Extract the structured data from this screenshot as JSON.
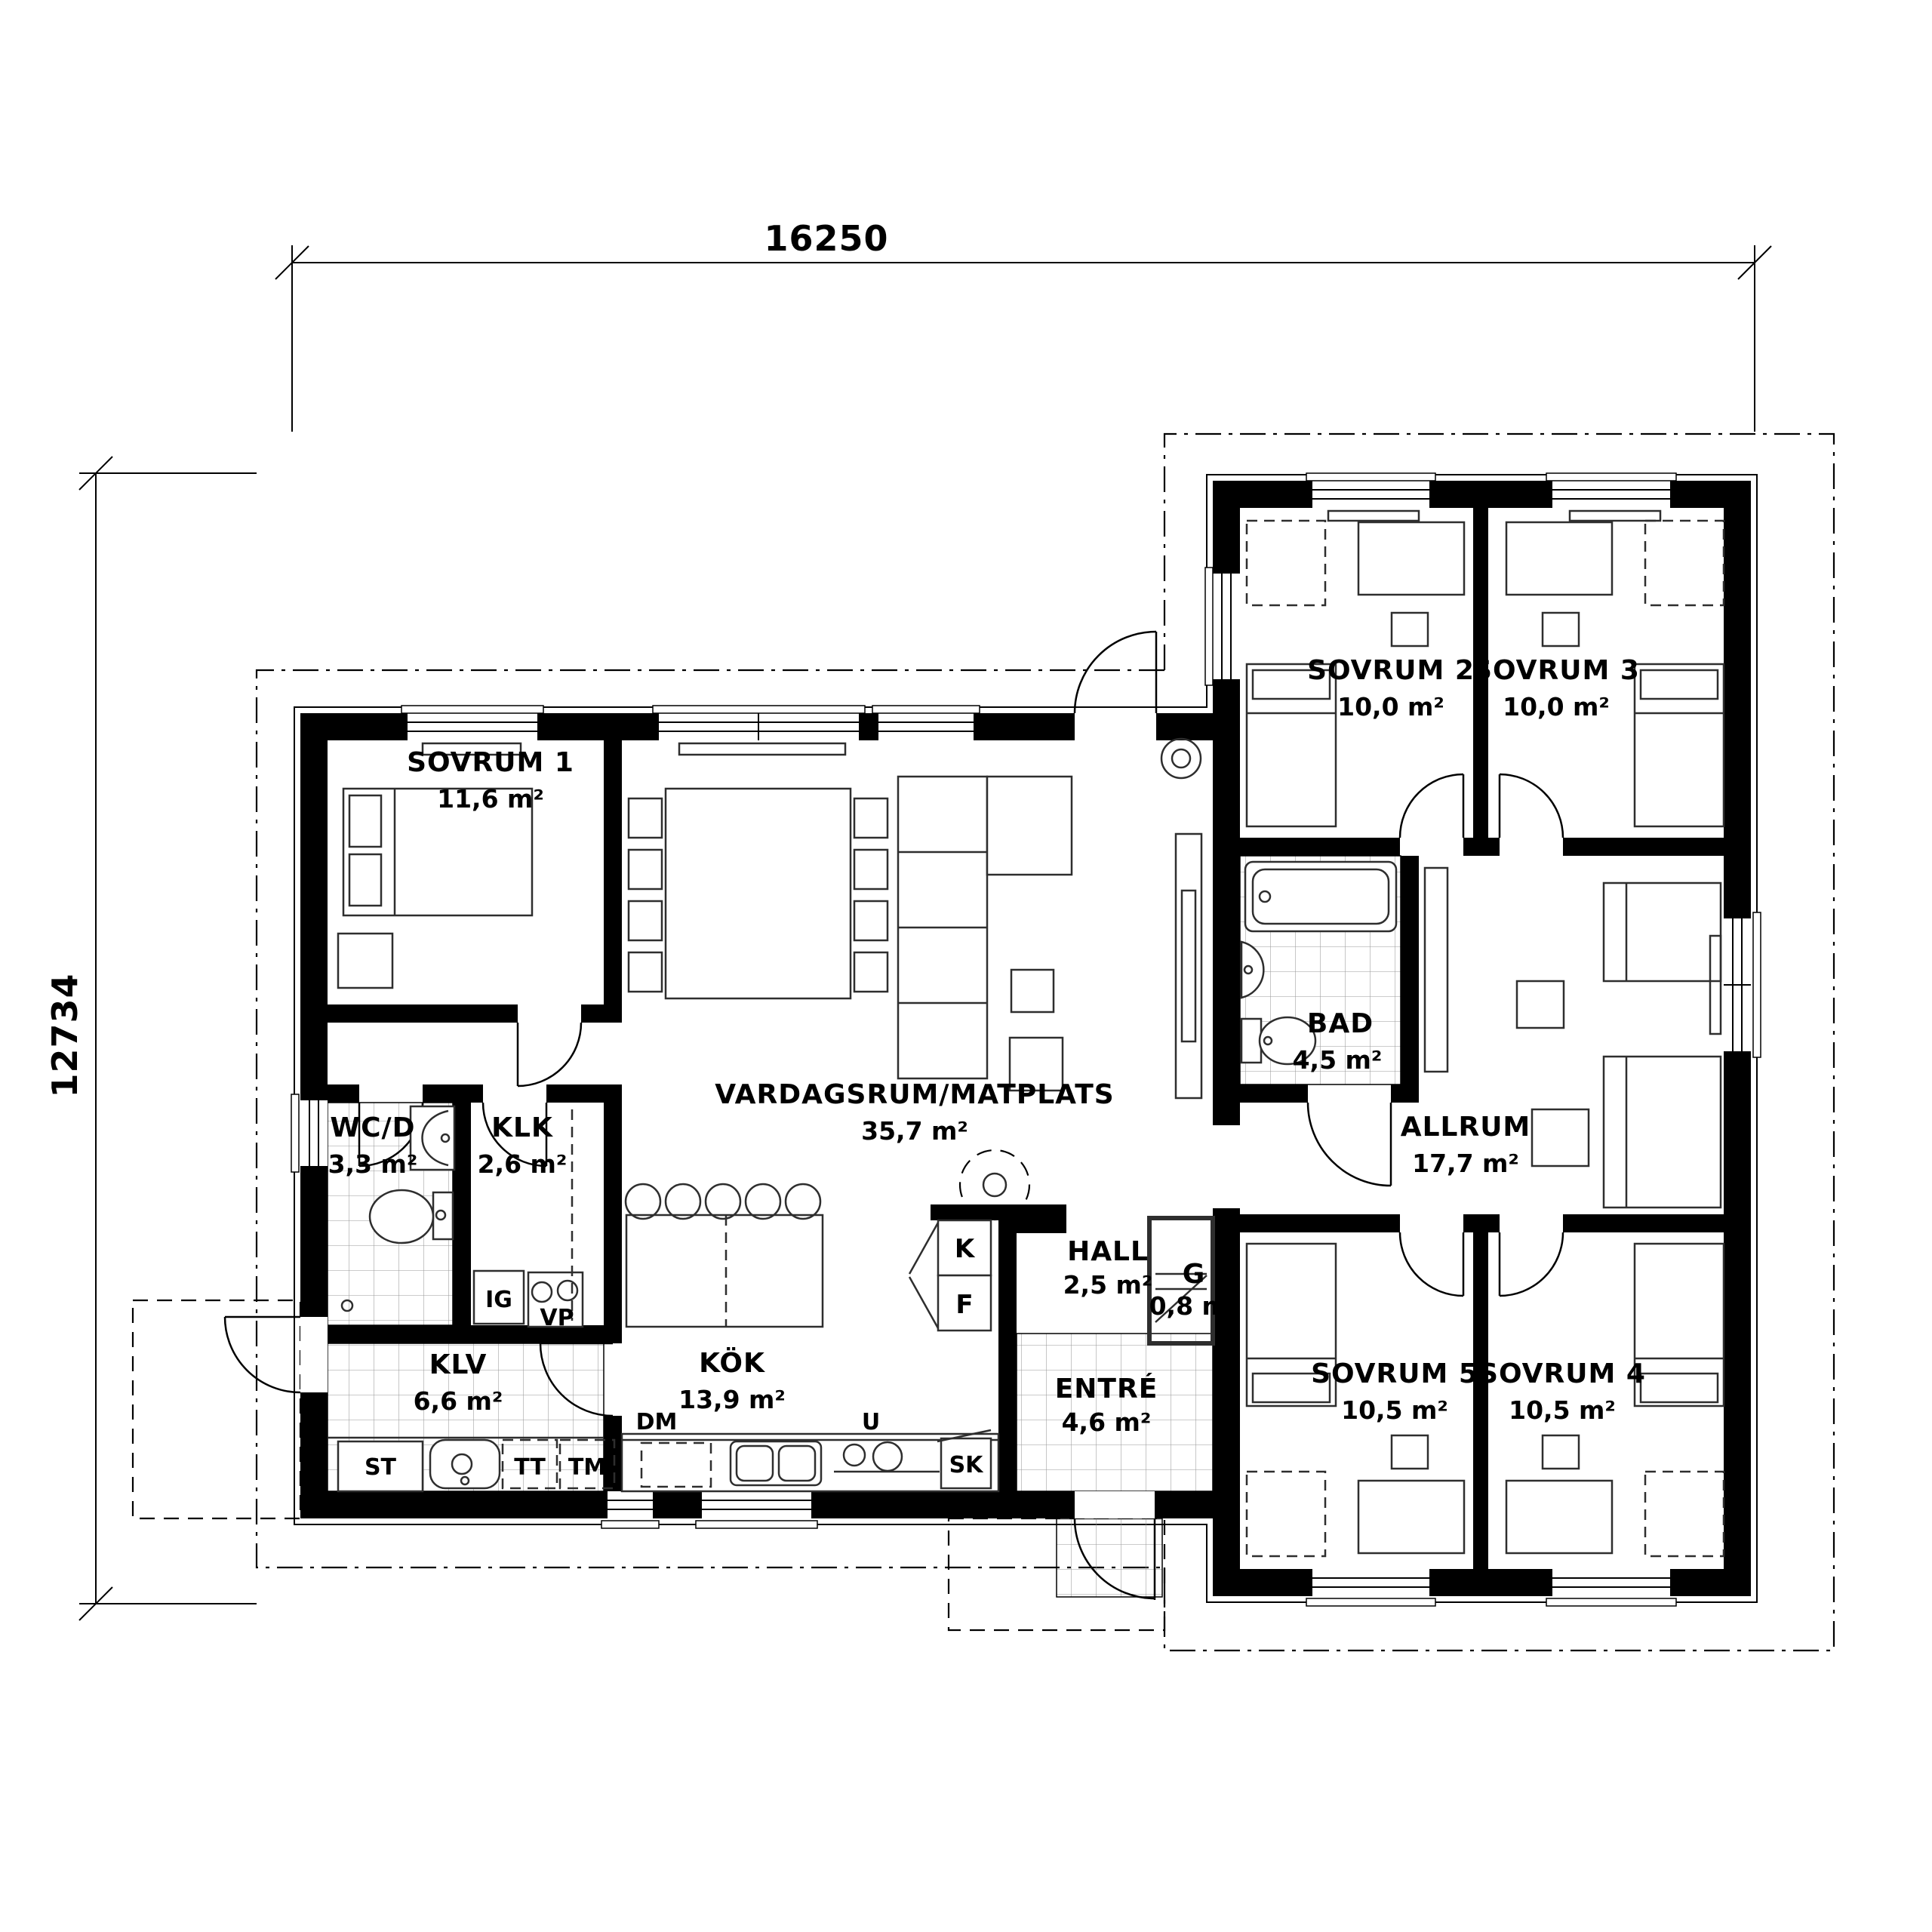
{
  "drawing": {
    "type": "floor-plan",
    "dimensions": {
      "top": "16250",
      "left": "12734"
    },
    "rooms": {
      "sovrum1": {
        "name": "SOVRUM 1",
        "area": "11,6 m²"
      },
      "sovrum2": {
        "name": "SOVRUM 2",
        "area": "10,0 m²"
      },
      "sovrum3": {
        "name": "SOVRUM 3",
        "area": "10,0 m²"
      },
      "sovrum4": {
        "name": "SOVRUM 4",
        "area": "10,5 m²"
      },
      "sovrum5": {
        "name": "SOVRUM 5",
        "area": "10,5 m²"
      },
      "bad": {
        "name": "BAD",
        "area": "4,5 m²"
      },
      "allrum": {
        "name": "ALLRUM",
        "area": "17,7 m²"
      },
      "vardagsrum": {
        "name": "VARDAGSRUM/MATPLATS",
        "area": "35,7 m²"
      },
      "wcd": {
        "name": "WC/D",
        "area": "3,3 m²"
      },
      "klk": {
        "name": "KLK",
        "area": "2,6 m²"
      },
      "klv": {
        "name": "KLV",
        "area": "6,6 m²"
      },
      "kok": {
        "name": "KÖK",
        "area": "13,9 m²"
      },
      "hall": {
        "name": "HALL",
        "area": "2,5 m²"
      },
      "g": {
        "name": "G",
        "area": "0,8 m²"
      },
      "entre": {
        "name": "ENTRÉ",
        "area": "4,6 m²"
      }
    },
    "fixtures": {
      "ig": "IG",
      "vp": "VP",
      "st": "ST",
      "tt": "TT",
      "tm": "TM",
      "dm": "DM",
      "u": "U",
      "sk": "SK",
      "k": "K",
      "f": "F"
    },
    "colors": {
      "wall": "#000000",
      "line": "#2e2e2e",
      "tile_grid": "#999999",
      "background": "#ffffff"
    }
  }
}
